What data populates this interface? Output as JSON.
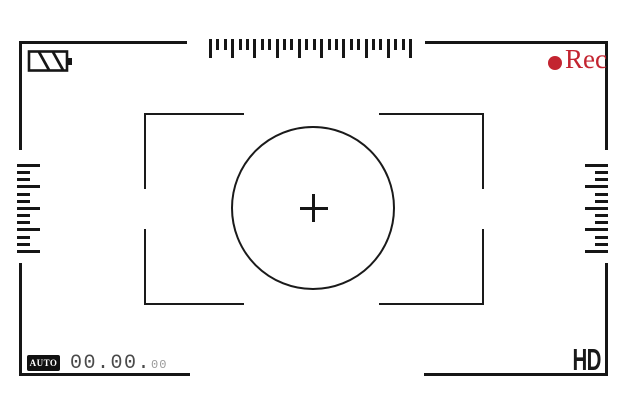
{
  "viewfinder": {
    "status_bar": {
      "battery_icon": "battery-striped",
      "rec_indicator": {
        "label": "Rec",
        "dot_icon": "record-dot",
        "color": "#c32430"
      }
    },
    "bottom_bar": {
      "mode_badge": "AUTO",
      "timecode": {
        "main": "00.00.",
        "frames": "00"
      },
      "quality_label": "HD"
    },
    "reticle": {
      "crosshair_icon": "plus-crosshair",
      "focus_circle": "circle-outline",
      "corner_brackets": 4
    },
    "rulers": {
      "top": {
        "orientation": "horizontal",
        "tick_count": 28,
        "major_every": 3
      },
      "left": {
        "orientation": "vertical",
        "tick_count": 13,
        "major_every": 3
      },
      "right": {
        "orientation": "vertical",
        "tick_count": 13,
        "major_every": 3
      }
    },
    "colors": {
      "line": "#161616",
      "rec_red": "#c32430",
      "timecode_dark": "#4a4a4a",
      "timecode_light": "#9a9a9a",
      "background": "#ffffff"
    }
  }
}
